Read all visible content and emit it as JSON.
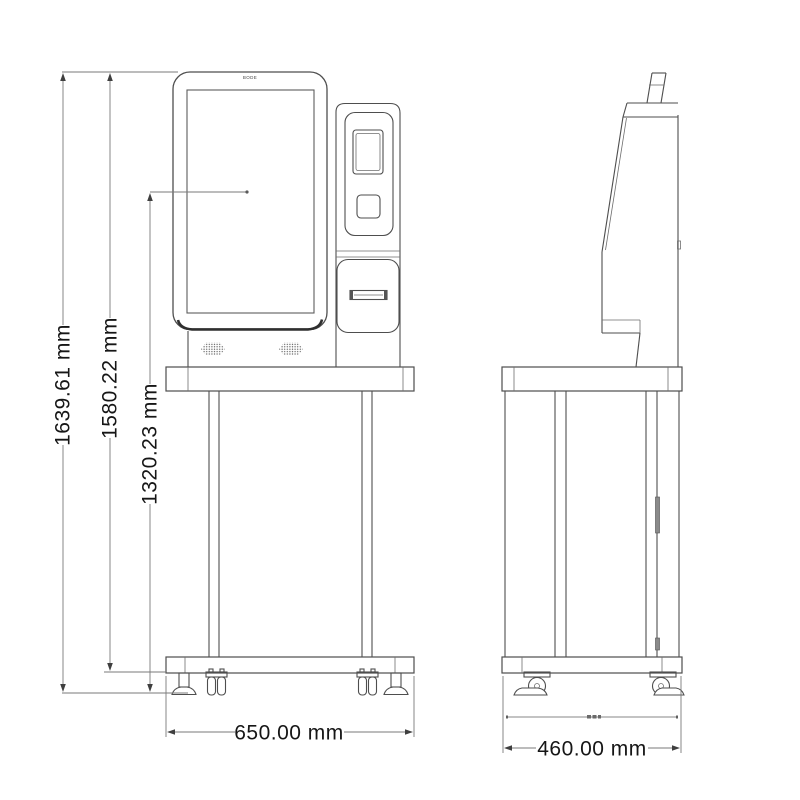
{
  "drawing": {
    "brand_logo": "BODE",
    "dimensions": {
      "total_height": "1639.61 mm",
      "frame_height": "1580.22 mm",
      "screen_center_height": "1320.23 mm",
      "base_width": "650.00 mm",
      "base_depth": "460.00 mm"
    }
  }
}
